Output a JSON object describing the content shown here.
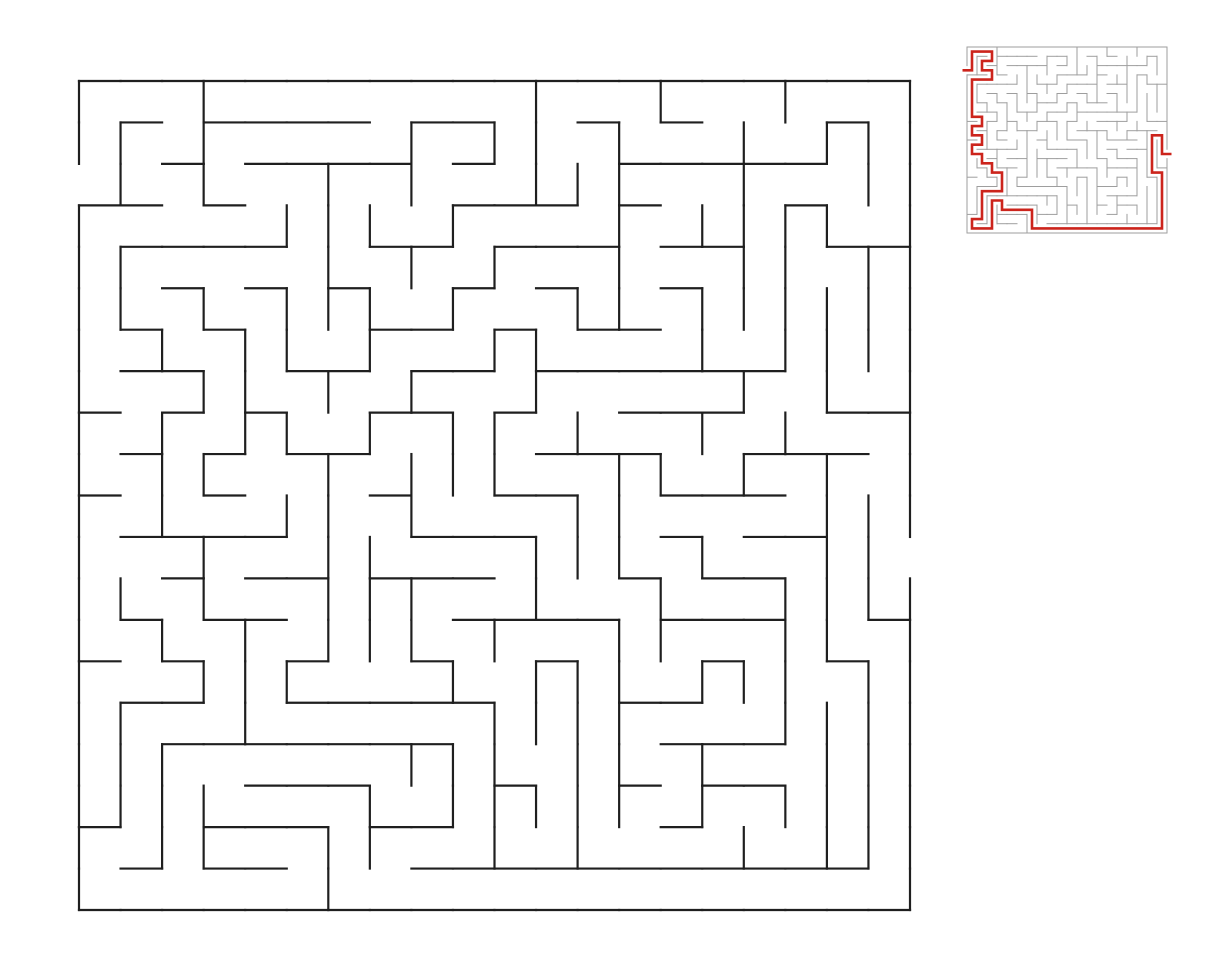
{
  "scene": {
    "background_color": "#ffffff",
    "width": 1225,
    "height": 980
  },
  "maze": {
    "cols": 20,
    "rows": 20,
    "entrance": {
      "side": "left",
      "row": 2
    },
    "exit": {
      "side": "right",
      "row": 11
    }
  },
  "generator": {
    "seed": 1987,
    "braid_probability": 0.1
  },
  "main_view": {
    "x": 79,
    "y": 81,
    "width": 831,
    "height": 829,
    "wall_color": "#1f1f1f",
    "wall_width": 2.2,
    "show_solution": false
  },
  "inset_view": {
    "x": 967,
    "y": 47,
    "width": 200,
    "height": 186,
    "wall_color": "#9e9e9e",
    "wall_width": 1,
    "show_solution": true,
    "solution_color": "#cc241c",
    "solution_width": 2.6,
    "solution_overhang": 0.45
  }
}
